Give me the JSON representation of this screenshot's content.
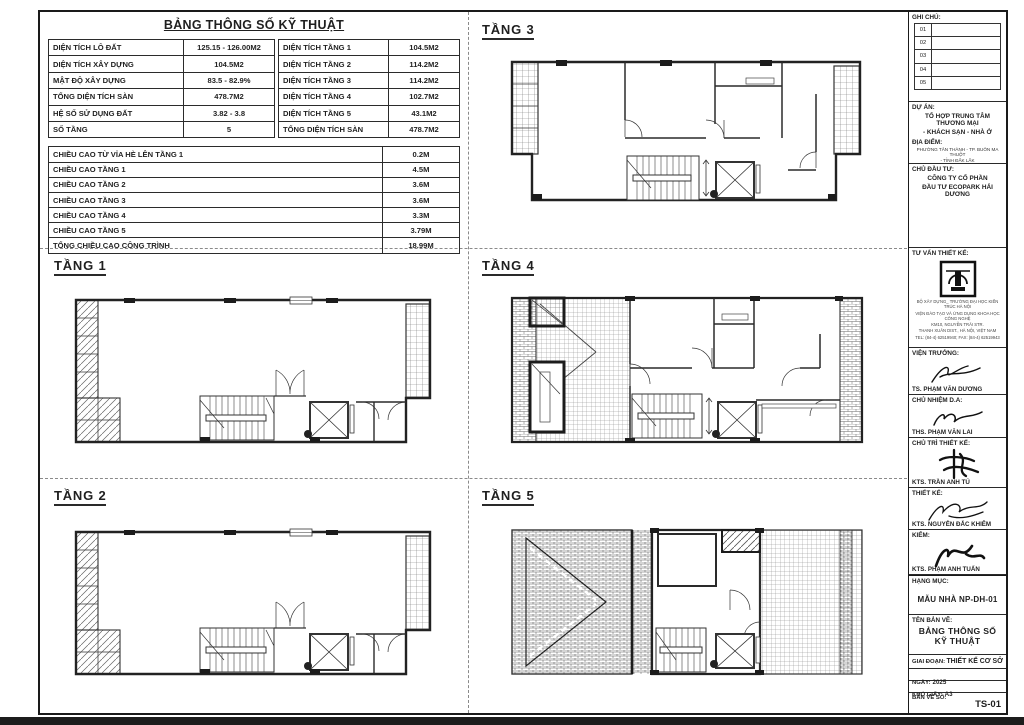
{
  "spec": {
    "title": "BẢNG THÔNG SỐ KỸ THUẬT",
    "left": [
      {
        "label": "DIỆN TÍCH LÔ ĐẤT",
        "value": "125.15 - 126.00M2"
      },
      {
        "label": "DIỆN TÍCH XÂY DỰNG",
        "value": "104.5M2"
      },
      {
        "label": "MẬT ĐỘ XÂY DỰNG",
        "value": "83.5 - 82.9%"
      },
      {
        "label": "TỔNG DIỆN TÍCH SÀN",
        "value": "478.7M2"
      },
      {
        "label": "HỆ SỐ SỬ DỤNG ĐẤT",
        "value": "3.82 - 3.8"
      },
      {
        "label": "SỐ TẦNG",
        "value": "5"
      }
    ],
    "right": [
      {
        "label": "DIỆN TÍCH TẦNG 1",
        "value": "104.5M2"
      },
      {
        "label": "DIỆN TÍCH TẦNG 2",
        "value": "114.2M2"
      },
      {
        "label": "DIỆN TÍCH TẦNG 3",
        "value": "114.2M2"
      },
      {
        "label": "DIỆN TÍCH TẦNG 4",
        "value": "102.7M2"
      },
      {
        "label": "DIỆN TÍCH TẦNG 5",
        "value": "43.1M2"
      },
      {
        "label": "TỔNG DIỆN TÍCH SÀN",
        "value": "478.7M2"
      }
    ],
    "heights": [
      {
        "label": "CHIỀU CAO TỪ VỈA HÈ LÊN TẦNG 1",
        "value": "0.2M"
      },
      {
        "label": "CHIỀU CAO TẦNG 1",
        "value": "4.5M"
      },
      {
        "label": "CHIỀU CAO TẦNG 2",
        "value": "3.6M"
      },
      {
        "label": "CHIỀU CAO TẦNG 3",
        "value": "3.6M"
      },
      {
        "label": "CHIỀU CAO TẦNG 4",
        "value": "3.3M"
      },
      {
        "label": "CHIỀU CAO TẦNG 5",
        "value": "3.79M"
      },
      {
        "label": "TỔNG CHIỀU CAO CÔNG TRÌNH",
        "value": "18.99M"
      }
    ]
  },
  "floors": {
    "f1": {
      "label": "TẦNG 1"
    },
    "f2": {
      "label": "TẦNG 2"
    },
    "f3": {
      "label": "TẦNG 3"
    },
    "f4": {
      "label": "TẦNG 4"
    },
    "f5": {
      "label": "TẦNG 5"
    }
  },
  "titleblock": {
    "notes": {
      "label": "GHI CHÚ:",
      "rows": [
        "01",
        "02",
        "03",
        "04",
        "05"
      ]
    },
    "project": {
      "label": "DỰ ÁN:",
      "line1": "TỔ HỢP TRUNG TÂM THƯƠNG MẠI",
      "line2": "- KHÁCH SẠN - NHÀ Ở"
    },
    "location": {
      "label": "ĐỊA ĐIỂM:",
      "line1": "PHƯỜNG TÂN THÀNH - TP. BUÔN MA THUỘT",
      "line2": "- TỈNH ĐẮK LẮK"
    },
    "investor": {
      "label": "CHỦ ĐẦU TƯ:",
      "line1": "CÔNG TY CỔ PHẦN",
      "line2": "ĐẦU TƯ ECOPARK HẢI DƯƠNG"
    },
    "consultant": {
      "label": "TƯ VẤN THIẾT KẾ:",
      "addr1": "BỘ XÂY DỰNG_ TRƯỜNG ĐẠI HỌC KIẾN TRÚC HÀ NỘI",
      "addr2": "VIỆN ĐÀO TẠO VÀ ỨNG DỤNG KHOA HỌC CÔNG NGHỆ",
      "addr3": "KM10, NGUYỄN TRÃI STR.",
      "addr4": "THANH XUÂN DIST., HÀ NỘI, VIỆT NAM",
      "addr5": "TEL: (84-4) 62519940; FAX: (84-4) 62519943"
    },
    "signers": [
      {
        "role": "VIỆN TRƯỞNG:",
        "name": "TS. PHẠM VĂN DƯƠNG"
      },
      {
        "role": "CHỦ NHIỆM D.A:",
        "name": "THS. PHẠM VĂN LAI"
      },
      {
        "role": "CHỦ TRÌ THIẾT KẾ:",
        "name": "KTS. TRẦN ANH TÚ"
      },
      {
        "role": "THIẾT KẾ:",
        "name": "KTS. NGUYỄN ĐẮC KHIÊM"
      },
      {
        "role": "KIỂM:",
        "name": "KTS. PHẠM ANH TUẤN"
      }
    ],
    "category": {
      "label": "HẠNG MỤC:",
      "value": "MẪU NHÀ NP-DH-01"
    },
    "drawing": {
      "label": "TÊN BẢN VẼ:",
      "line1": "BẢNG THÔNG SỐ",
      "line2": "KỸ THUẬT"
    },
    "stage": {
      "label": "GIAI ĐOẠN:",
      "value": "THIẾT KẾ CƠ SỞ"
    },
    "date": {
      "label": "NGÀY:",
      "value": "2025"
    },
    "paper": {
      "label": "KHỔ GIẤY:",
      "value": "A3"
    },
    "sheet_no": {
      "label": "BẢN VẼ SỐ:",
      "value": "TS-01"
    }
  },
  "colors": {
    "ink": "#1f1f1f",
    "hatch": "#666666"
  }
}
